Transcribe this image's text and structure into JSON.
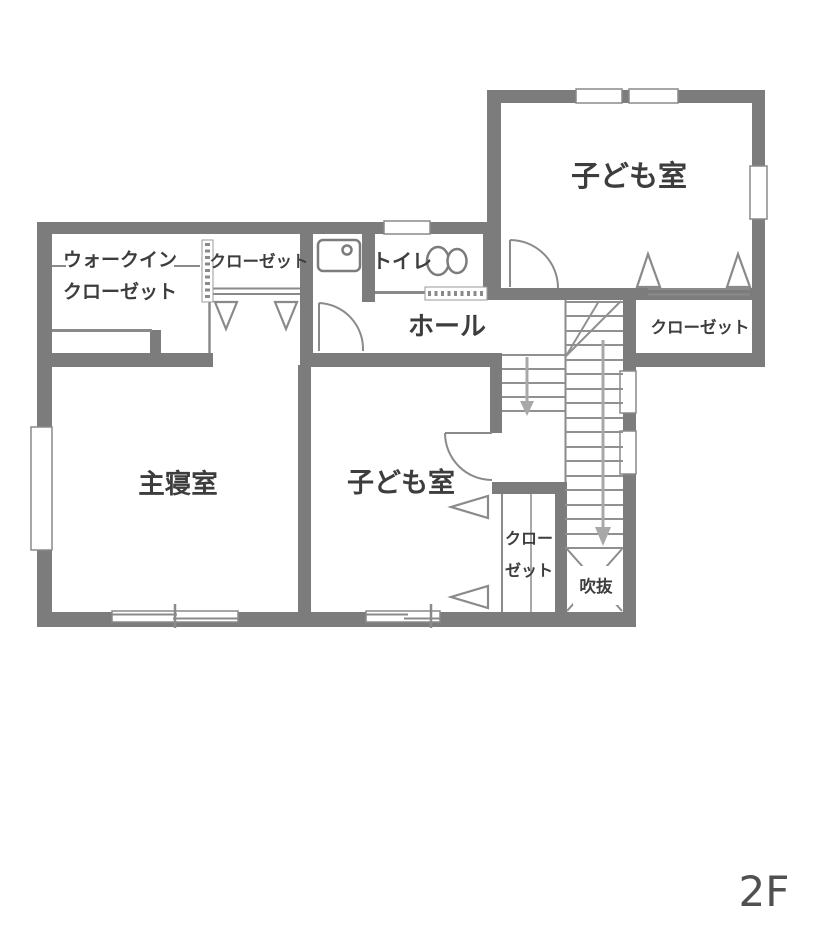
{
  "floor_label": "2F",
  "rooms": {
    "child_room_1": {
      "label": "子ども室"
    },
    "child_room_1_closet": {
      "label": "クローゼット"
    },
    "walk_in_closet": {
      "label_line1": "ウォークイン",
      "label_line2": "クローゼット"
    },
    "closet_upper": {
      "label": "クローゼット"
    },
    "toilet": {
      "label": "トイレ"
    },
    "hall": {
      "label": "ホール"
    },
    "master_bedroom": {
      "label": "主寝室"
    },
    "child_room_2": {
      "label": "子ども室"
    },
    "child_room_2_closet": {
      "label_line1": "クロー",
      "label_line2": "ゼット"
    },
    "void": {
      "label": "吹抜"
    }
  },
  "stairs": {
    "direction": "down"
  },
  "colors": {
    "wall": "#7c7c7c",
    "line": "#8a8a8a",
    "text": "#3d3d3d",
    "background": "#ffffff"
  }
}
